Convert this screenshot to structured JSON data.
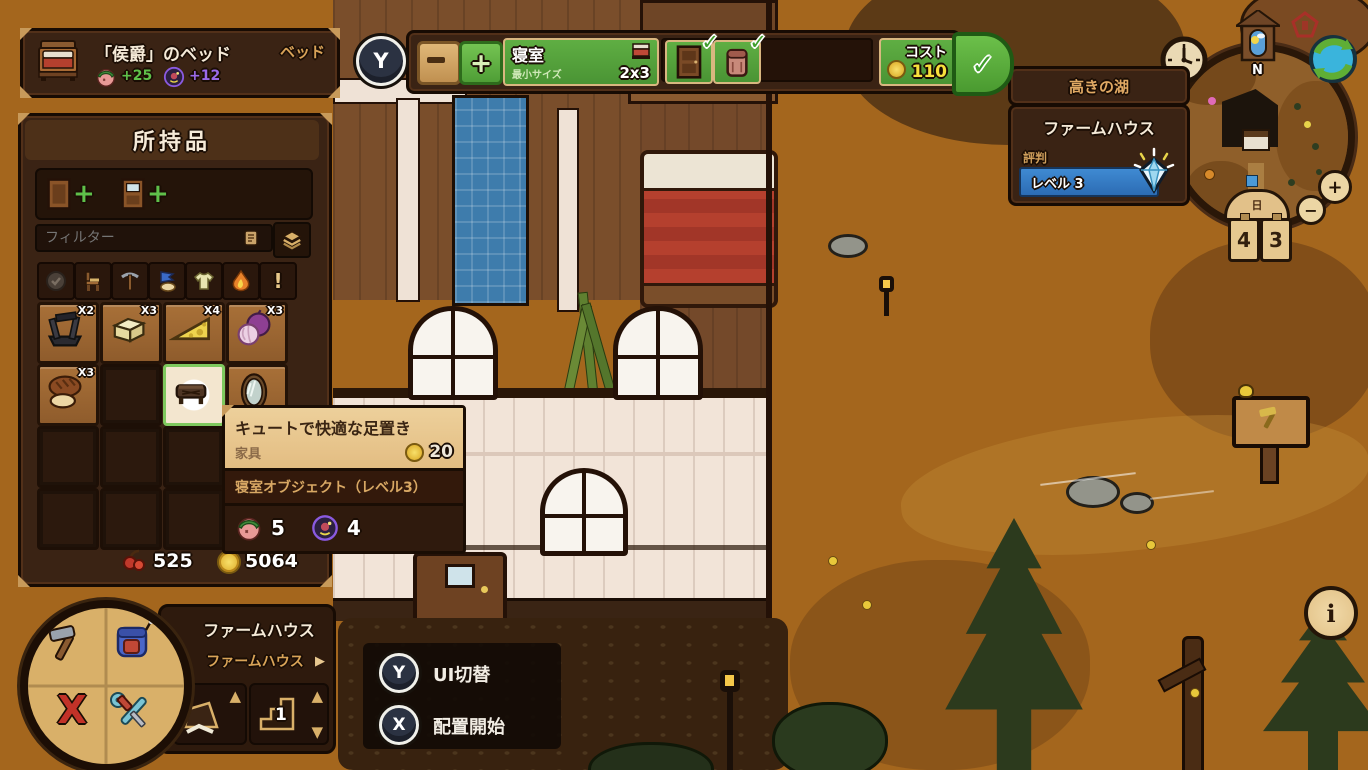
{
  "controller": {
    "y": "Y",
    "x": "X"
  },
  "icons": {
    "check": "✓",
    "play_right": "▶",
    "tri_up": "▲",
    "tri_down": "▼",
    "plus": "+",
    "info": "i",
    "exclaim": "!"
  },
  "bed_tooltip": {
    "title": "「侯爵」のベッド",
    "category": "ベッド",
    "buff_green": "+25",
    "buff_purple": "+12"
  },
  "room_toolbar": {
    "room_name": "寝室",
    "min_size_label": "最小サイズ",
    "size": "2x3",
    "cost_label": "コスト",
    "cost": "110"
  },
  "location_panel": {
    "region": "高きの湖",
    "building": "ファームハウス",
    "reputation_label": "評判",
    "level": "レベル 3"
  },
  "minimap": {
    "compass_north": "N",
    "day_label": "日",
    "plate_left": "4",
    "plate_right": "3"
  },
  "inventory": {
    "title": "所持品",
    "filter_placeholder": "フィルター",
    "wood_count": "525",
    "coin_count": "5064",
    "items": [
      {
        "name": "loom",
        "count": "X2"
      },
      {
        "name": "butter",
        "count": "X3"
      },
      {
        "name": "cheese",
        "count": "X4"
      },
      {
        "name": "onion",
        "count": "X3"
      },
      {
        "name": "bread",
        "count": "X3"
      },
      {
        "name": "footrest",
        "count": ""
      },
      {
        "name": "mirror",
        "count": ""
      }
    ]
  },
  "footrest_tooltip": {
    "title": "キュートで快適な足置き",
    "category": "家具",
    "price": "20",
    "requirement": "寝室オブジェクト（レベル3）",
    "stat_green": "5",
    "stat_purple": "4"
  },
  "build_menu": {
    "title": "ファームハウス",
    "selected": "ファームハウス",
    "floor": "1"
  },
  "hints": {
    "y_label": "UI切替",
    "x_label": "配置開始"
  }
}
